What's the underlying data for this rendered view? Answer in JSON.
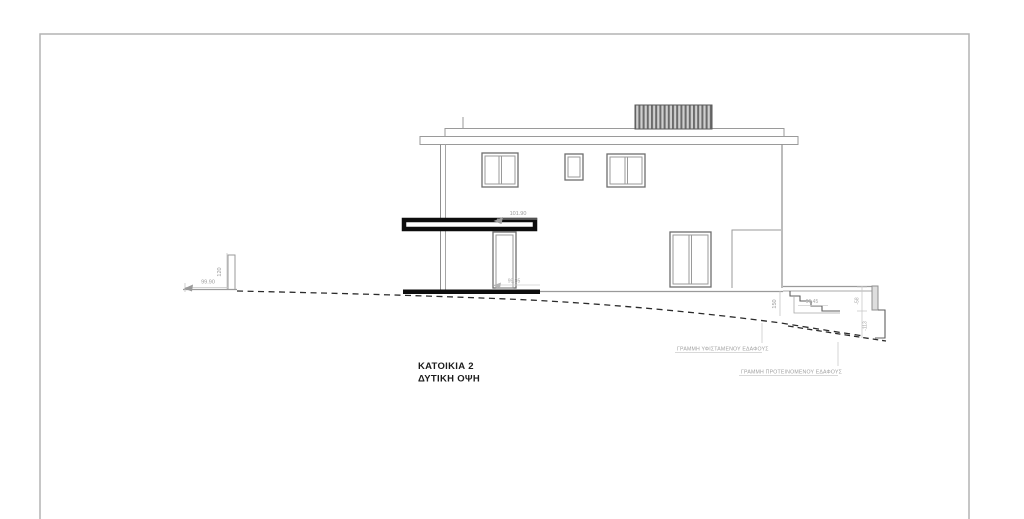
{
  "drawing": {
    "title_line1": "ΚΑΤΟΙΚΙΑ 2",
    "title_line2": "ΔΥΤΙΚΗ ΟΨΗ",
    "annotations": {
      "existing_ground": "ΓΡΑΜΜΗ ΥΦΙΣΤΑΜΕΝΟΥ ΕΔΑΦΟΥΣ",
      "proposed_ground": "ΓΡΑΜΜΗ ΠΡΟΤΕΙΝΟΜΕΝΟΥ ΕΔΑΦΟΥΣ"
    },
    "dimensions": {
      "canopy_level": "101.90",
      "left_ground_level": "99.90",
      "left_wall_height": "120",
      "door_level": "99.95",
      "terrace_height": "150",
      "stair_level": "96.45",
      "right_upper_level": "-58",
      "right_lower_level": "-113"
    },
    "colors": {
      "line": "#8f8f8f",
      "dark": "#111111",
      "dim_line": "#c4c4c4",
      "ground_dash": "#2b2b2b",
      "page_border": "#b3b3b3"
    }
  }
}
